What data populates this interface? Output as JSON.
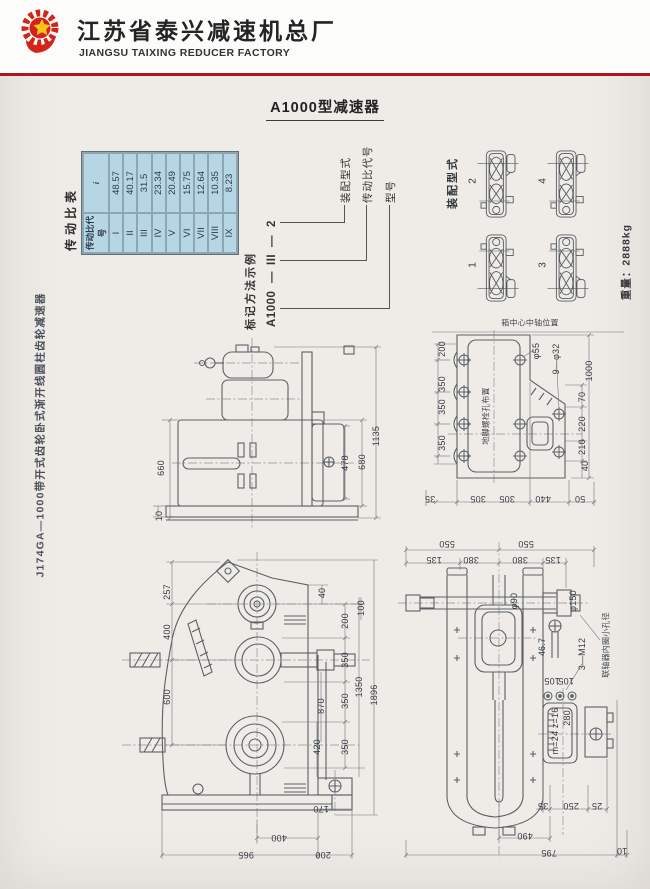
{
  "header": {
    "logo": "gear-star-logo",
    "company_cn": "江苏省泰兴减速机总厂",
    "company_en": "JIANGSU TAIXING REDUCER FACTORY"
  },
  "page_title": "A1000型减速器",
  "side_note": "J174GA—1000带开式齿轮卧式渐开线圆柱齿轮减速器",
  "ratio_table": {
    "title": "传动比表",
    "header": [
      "传动比代号",
      "i"
    ],
    "rows": [
      [
        "I",
        "48.57"
      ],
      [
        "II",
        "40.17"
      ],
      [
        "III",
        "31.5"
      ],
      [
        "IV",
        "23.34"
      ],
      [
        "V",
        "20.49"
      ],
      [
        "VI",
        "15.75"
      ],
      [
        "VII",
        "12.64"
      ],
      [
        "VIII",
        "10.35"
      ],
      [
        "IX",
        "8.23"
      ]
    ]
  },
  "designation": {
    "title": "标记方法示例",
    "model": "A1000",
    "dash1": "—",
    "ratio_code": "III",
    "dash2": "—",
    "assembly_code": "2",
    "labels": {
      "assembly": "装配型式",
      "ratio": "传动比代号",
      "model": "型号"
    }
  },
  "assembly": {
    "title": "装配型式",
    "variants": [
      "1",
      "2",
      "3",
      "4"
    ],
    "weight": "重量：2888kg"
  },
  "drawings": {
    "elevation": {
      "dims": [
        "660",
        "10",
        "478",
        "680",
        "1135"
      ]
    },
    "foundation": {
      "caption": "箱中心中轴位置",
      "inner_label": "地脚螺栓孔布置",
      "left_dims": [
        "200",
        "350",
        "350",
        "350"
      ],
      "hole_labels": [
        "φ55",
        "9—φ32"
      ],
      "right_dims": [
        "1000",
        "70",
        "220",
        "210",
        "40"
      ],
      "bottom_dims": [
        "35",
        "305",
        "305",
        "440",
        "50"
      ]
    },
    "front": {
      "left_dims": [
        "257",
        "400",
        "600"
      ],
      "right_dims": [
        "40",
        "100",
        "200",
        "350",
        "1350",
        "1896",
        "350",
        "870",
        "420",
        "350",
        "170"
      ],
      "bottom_dims": [
        "400",
        "965",
        "200"
      ]
    },
    "side": {
      "top_dims": [
        "550",
        "550",
        "135",
        "380",
        "380",
        "135"
      ],
      "labels": [
        "φ90",
        "φ150",
        "46.7",
        "3—M12",
        "联轴器内圈小孔径",
        "105",
        "105",
        "280",
        "m=24 z=16"
      ],
      "bottom_dims": [
        "35",
        "250",
        "25",
        "490",
        "795",
        "10"
      ]
    }
  },
  "colors": {
    "accent_red": "#b5121f",
    "table_cell": "#b7d6e5",
    "line": "#5b6065"
  }
}
